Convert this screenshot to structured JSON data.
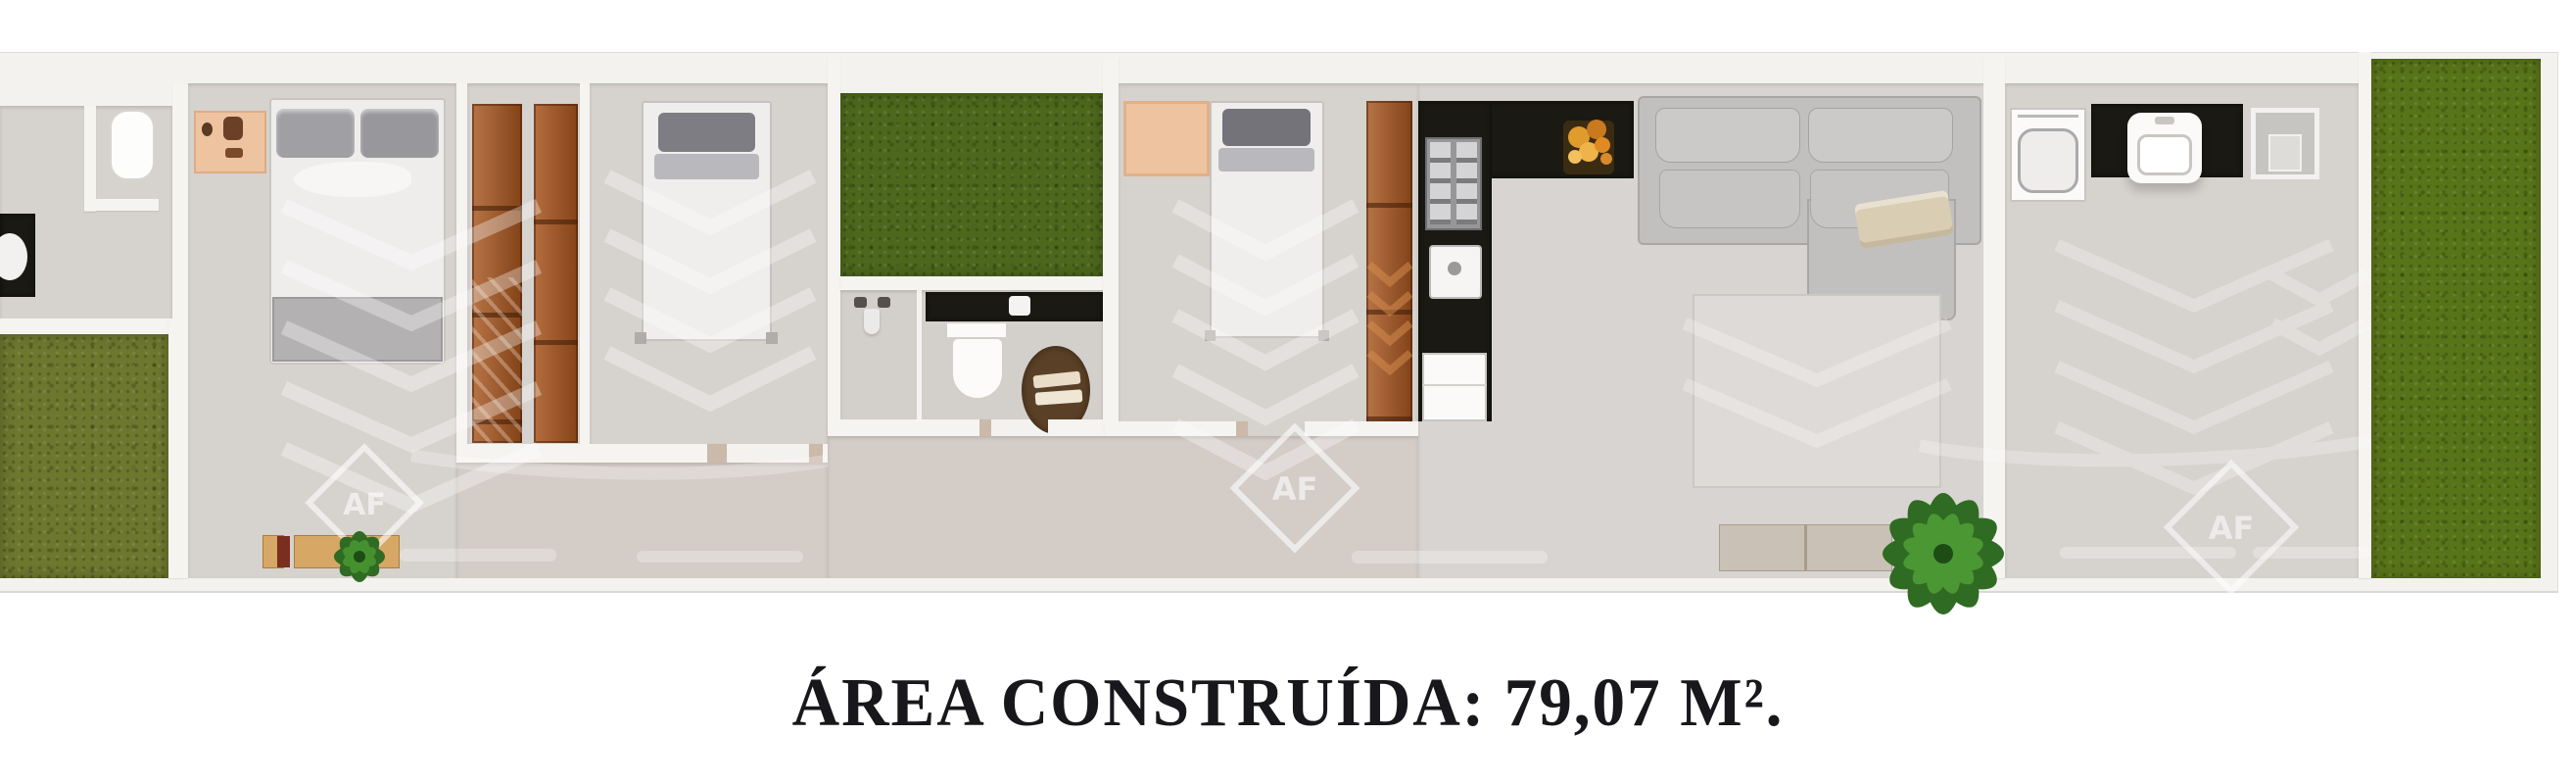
{
  "caption": {
    "text": "ÁREA CONSTRUÍDA: 79,07 M²."
  },
  "watermark": {
    "monogram": "AF"
  },
  "palette": {
    "background": "#ffffff",
    "wall_white": "#f4f2ef",
    "floor_gray": "#d6d2ce",
    "corridor_floor": "#d3ccc7",
    "courtyard_grass": "#4d681c",
    "left_yard_grass": "#6d772e",
    "right_yard_grass": "#587419",
    "wood_deck": "#a7551e",
    "counter_black": "#1a1913",
    "sofa_gray": "#c2c0bf",
    "accent_peach": "#eec3a0",
    "bench_tan": "#d7a766",
    "rug_brown": "#5a4026",
    "plant_green": "#3f8a2b",
    "caption_color": "#18171b"
  }
}
